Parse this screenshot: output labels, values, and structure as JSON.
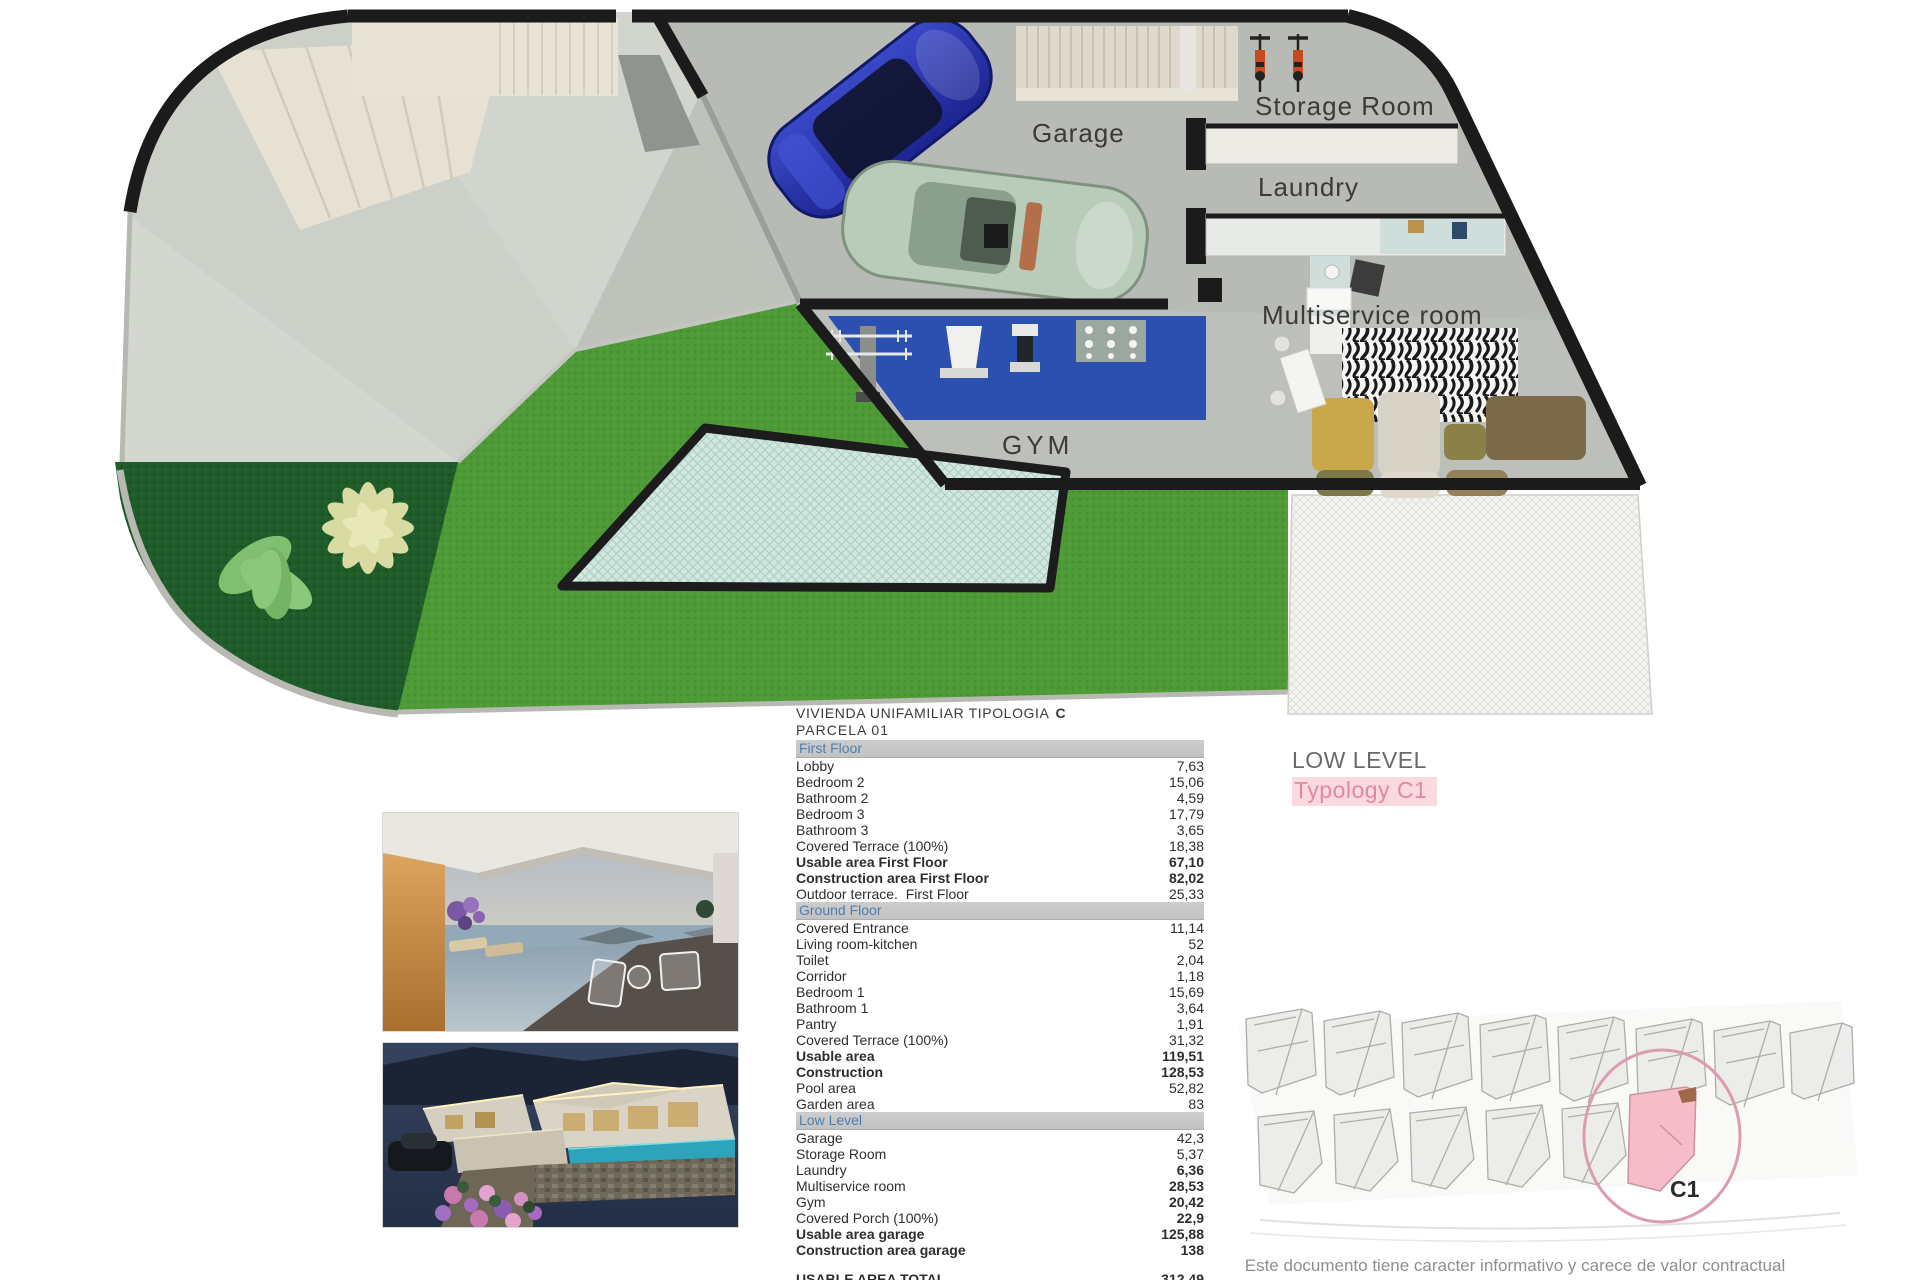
{
  "plan": {
    "labels": {
      "garage": "Garage",
      "storage_room": "Storage Room",
      "laundry": "Laundry",
      "multiservice": "Multiservice room",
      "gym": "GYM"
    },
    "level_tag": {
      "level": "LOW LEVEL",
      "typology": "Typology C1"
    }
  },
  "table": {
    "title": "VIVIENDA UNIFAMILIAR TIPOLOGIA",
    "title_code": "C",
    "subtitle": "PARCELA  01",
    "sections": [
      {
        "header": "First Floor",
        "rows": [
          {
            "label": "Lobby",
            "value": "7,63"
          },
          {
            "label": "Bedroom 2",
            "value": "15,06"
          },
          {
            "label": "Bathroom 2",
            "value": "4,59"
          },
          {
            "label": "Bedroom 3",
            "value": "17,79"
          },
          {
            "label": "Bathroom 3",
            "value": "3,65"
          },
          {
            "label": "Covered Terrace (100%)",
            "value": "18,38"
          },
          {
            "label": "Usable area First Floor",
            "value": "67,10",
            "lb": true,
            "vb": true
          },
          {
            "label": "Construction area First Floor",
            "value": "82,02",
            "lb": true,
            "vb": true
          },
          {
            "label": "Outdoor terrace.  First Floor",
            "value": "25,33"
          }
        ]
      },
      {
        "header": "Ground Floor",
        "rows": [
          {
            "label": "Covered Entrance",
            "value": "11,14"
          },
          {
            "label": "Living room-kitchen",
            "value": "52"
          },
          {
            "label": "Toilet",
            "value": "2,04"
          },
          {
            "label": "Corridor",
            "value": "1,18"
          },
          {
            "label": "Bedroom 1",
            "value": "15,69"
          },
          {
            "label": "Bathroom 1",
            "value": "3,64"
          },
          {
            "label": "Pantry",
            "value": "1,91"
          },
          {
            "label": "Covered Terrace (100%)",
            "value": "31,32"
          },
          {
            "label": "Usable area",
            "value": "119,51",
            "lb": true,
            "vb": true
          },
          {
            "label": "Construction",
            "value": "128,53",
            "lb": true,
            "vb": true
          },
          {
            "label": "Pool area",
            "value": "52,82"
          },
          {
            "label": "Garden area",
            "value": "83"
          }
        ]
      },
      {
        "header": "Low Level",
        "rows": [
          {
            "label": "Garage",
            "value": "42,3"
          },
          {
            "label": "Storage Room",
            "value": "5,37"
          },
          {
            "label": "Laundry",
            "value": "6,36",
            "vb": true
          },
          {
            "label": "Multiservice room",
            "value": "28,53",
            "vb": true
          },
          {
            "label": "Gym",
            "value": "20,42",
            "vb": true
          },
          {
            "label": "Covered Porch (100%)",
            "value": "22,9",
            "vb": true
          },
          {
            "label": "Usable area garage",
            "value": "125,88",
            "lb": true,
            "vb": true
          },
          {
            "label": "Construction area garage",
            "value": "138",
            "lb": true,
            "vb": true
          }
        ]
      }
    ],
    "totals": [
      {
        "label": "USABLE AREA TOTAL",
        "value": "312,49"
      },
      {
        "label": "CONSTRUCTION AREA TOTAL",
        "value": "348,55"
      }
    ]
  },
  "siteplan": {
    "highlight_label": "C1"
  },
  "disclaimer": "Este documento tiene caracter informativo y carece de valor contractual",
  "colors": {
    "wall_black": "#1b1b1b",
    "lawn_green": "#4d9a37",
    "bed_dark_green": "#1f5c2a",
    "pool_teal": "#d3e6e0",
    "gym_blue": "#2b50b0",
    "accent_pink": "#e487a2",
    "section_header_text": "#4e7dad"
  }
}
